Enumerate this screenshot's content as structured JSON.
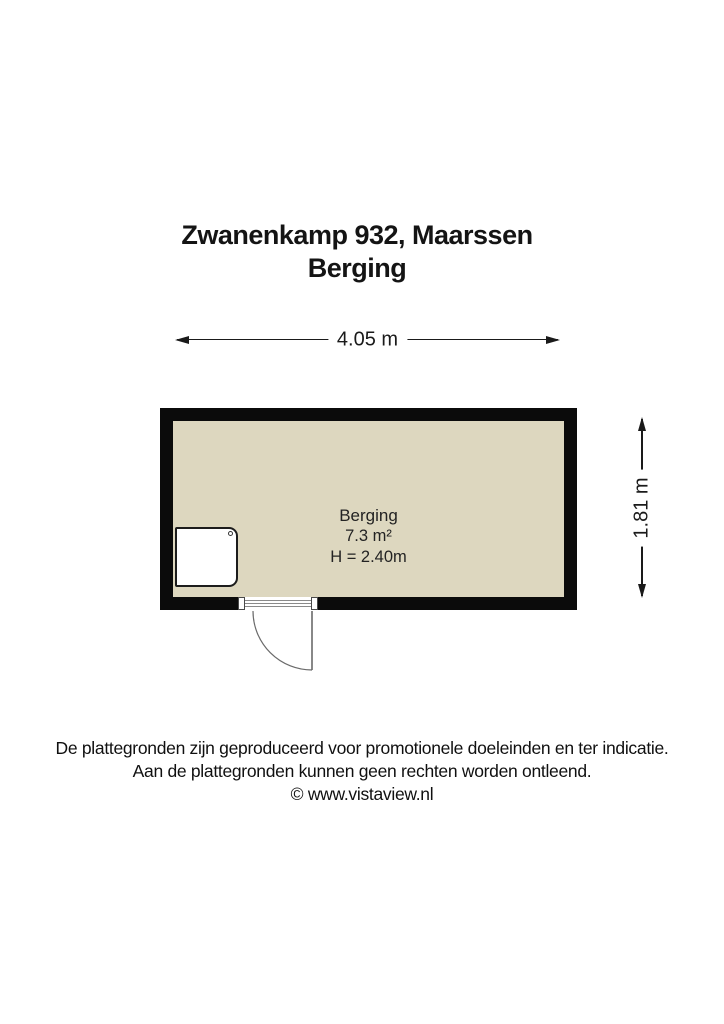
{
  "title": {
    "line1": "Zwanenkamp 932, Maarssen",
    "line2": "Berging"
  },
  "dimensions": {
    "width": "4.05 m",
    "height": "1.81 m"
  },
  "room": {
    "name": "Berging",
    "area": "7.3 m²",
    "ceiling_height": "H = 2.40m"
  },
  "footer": {
    "line1": "De plattegronden zijn geproduceerd voor promotionele doeleinden en ter indicatie.",
    "line2": "Aan de plattegronden kunnen geen rechten worden ontleend.",
    "copyright": "© www.vistaview.nl"
  },
  "colors": {
    "wall": "#0b0b0b",
    "floor": "#ddd7bf",
    "text": "#1a1a1a",
    "door_line": "#6a6a6a"
  }
}
